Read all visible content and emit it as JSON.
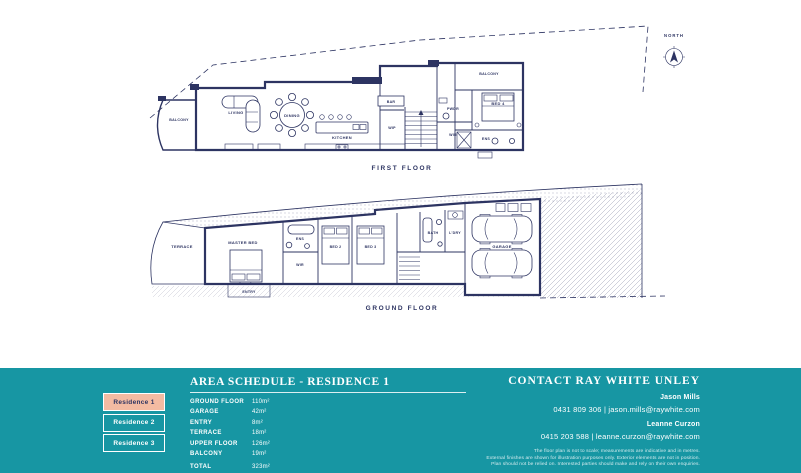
{
  "compass": {
    "label": "NORTH"
  },
  "plans": {
    "first": {
      "title": "FIRST FLOOR",
      "rooms": {
        "balcony_left": "BALCONY",
        "living": "LIVING",
        "dining": "DINING",
        "kitchen": "KITCHEN",
        "bar": "BAR",
        "wip": "WIP",
        "pwdr": "PWDR",
        "wir": "WIR",
        "bed4": "BED 4",
        "ens": "ENS",
        "balcony_right": "BALCONY"
      }
    },
    "ground": {
      "title": "GROUND FLOOR",
      "rooms": {
        "terrace": "TERRACE",
        "master_bed": "MASTER BED",
        "ens": "ENS",
        "wir": "WIR",
        "entry": "ENTRY",
        "bed2": "BED 2",
        "bed3": "BED 3",
        "bath": "BATH",
        "laundry": "L'DRY",
        "garage": "GARAGE"
      }
    }
  },
  "footer": {
    "colors": {
      "teal": "#1796A3",
      "peach": "#F3BBA2",
      "navy": "#2D3462"
    },
    "residences": [
      {
        "label": "Residence 1",
        "active": true
      },
      {
        "label": "Residence 2",
        "active": false
      },
      {
        "label": "Residence 3",
        "active": false
      }
    ],
    "area_schedule": {
      "title": "AREA SCHEDULE - RESIDENCE 1",
      "rows": [
        [
          "GROUND FLOOR",
          "110m²"
        ],
        [
          "GARAGE",
          "42m²"
        ],
        [
          "ENTRY",
          "8m²"
        ],
        [
          "TERRACE",
          "18m²"
        ],
        [
          "UPPER FLOOR",
          "126m²"
        ],
        [
          "BALCONY",
          "19m²"
        ]
      ],
      "total_label": "TOTAL",
      "total_value": "323m²"
    },
    "contact": {
      "title": "CONTACT RAY WHITE UNLEY",
      "agents": [
        {
          "name": "Jason Mills",
          "line": "0431 809 306  |  jason.mills@raywhite.com"
        },
        {
          "name": "Leanne Curzon",
          "line": "0415 203 588  |  leanne.curzon@raywhite.com"
        }
      ],
      "disclaimer": [
        "The floor plan is not to scale; measurements are indicative and in metres.",
        "External finishes are shown for illustration purposes only. Exterior elements are not in position.",
        "Plan should not be relied on. Interested parties should make and rely on their own enquiries."
      ]
    }
  }
}
